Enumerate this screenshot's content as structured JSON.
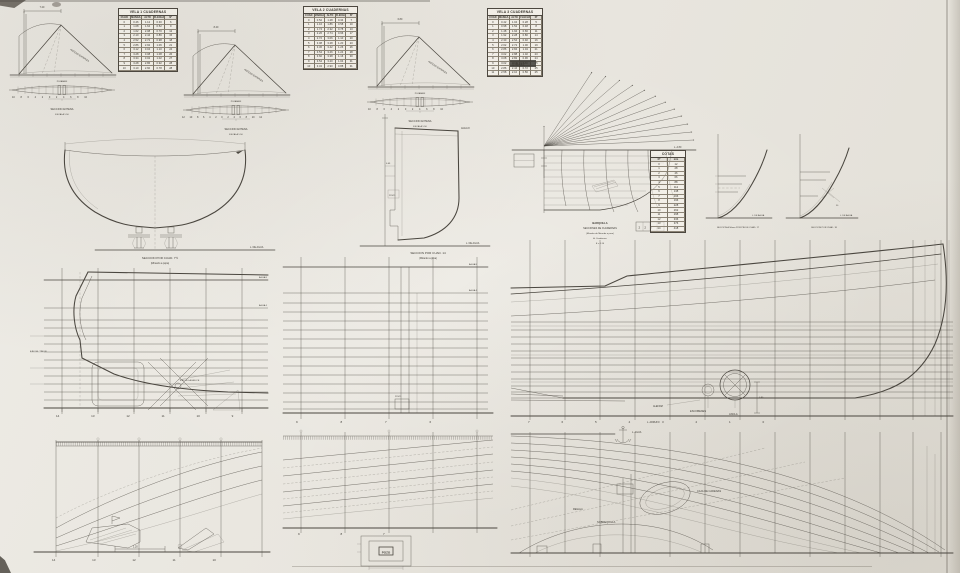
{
  "marks": {
    "corner_note": "2-8-32"
  },
  "sail_units": [
    {
      "leech_label": "ANTENA ENTERIZA",
      "mast_dim": "7.20",
      "base_label": "PUJAMEN",
      "plan_caption": "SECCION ANTENA",
      "sub_caption": "ESCALA 1:50"
    },
    {
      "leech_label": "ANTENA ENTERIZA",
      "mast_dim": "8.40",
      "base_label": "PUJAMEN",
      "plan_caption": "SECCION ANTENA",
      "sub_caption": "ESCALA 1:50"
    },
    {
      "leech_label": "ANTENA ENTERIZA",
      "mast_dim": "6.80",
      "base_label": "PUJAMEN",
      "plan_caption": "SECCION ANTENA",
      "sub_caption": "ESCALA 1:50"
    }
  ],
  "ticks": {
    "sail1": "10 8 6 4 2 0 2 4 6 8 10",
    "sail2": "12 10 8 6 4 2 0 2 4 6 8 10 12",
    "sail3": "10 8 6 4 2 0 2 4 6 8 10",
    "stern_profile": "14 13 12 11 10 9",
    "mid_profile": "9 8 7 6",
    "bow_profile": "7 6 5 4 3 2 1 0",
    "stern_plan": "14 13 12 11 10",
    "mid_plan": "9 8 7"
  },
  "sail_tables": [
    {
      "title": "VELA 1  CUADERNAS",
      "col_headers": [
        "CUAD",
        "MANGA",
        "ALTO",
        "FLECHA",
        "Nº"
      ],
      "rows": [
        [
          "0",
          "0.46",
          "1.12",
          "0.30",
          "6"
        ],
        [
          "1",
          "1.08",
          "1.64",
          "0.52",
          "9"
        ],
        [
          "2",
          "1.62",
          "2.08",
          "0.70",
          "12"
        ],
        [
          "3",
          "2.10",
          "2.44",
          "0.86",
          "15"
        ],
        [
          "4",
          "2.52",
          "2.72",
          "0.98",
          "18"
        ],
        [
          "5",
          "2.86",
          "2.92",
          "1.06",
          "21"
        ],
        [
          "6",
          "3.12",
          "3.04",
          "1.10",
          "24"
        ],
        [
          "7",
          "3.28",
          "3.08",
          "1.08",
          "26"
        ],
        [
          "8",
          "3.34",
          "3.02",
          "1.02",
          "27"
        ],
        [
          "9",
          "3.28",
          "2.86",
          "0.92",
          "28"
        ],
        [
          "10",
          "3.10",
          "2.60",
          "0.78",
          "28"
        ]
      ]
    },
    {
      "title": "VELA 2  CUADERNAS",
      "col_headers": [
        "CUAD",
        "MANGA",
        "ALTO",
        "FLECHA",
        "Nº"
      ],
      "rows": [
        [
          "0",
          "0.52",
          "1.28",
          "0.34",
          "7"
        ],
        [
          "1",
          "1.16",
          "1.86",
          "0.58",
          "10"
        ],
        [
          "2",
          "1.74",
          "2.32",
          "0.78",
          "13"
        ],
        [
          "3",
          "2.26",
          "2.74",
          "0.96",
          "17"
        ],
        [
          "4",
          "2.72",
          "3.06",
          "1.10",
          "20"
        ],
        [
          "5",
          "3.08",
          "3.28",
          "1.20",
          "23"
        ],
        [
          "6",
          "3.36",
          "3.42",
          "1.26",
          "26"
        ],
        [
          "7",
          "3.54",
          "3.46",
          "1.24",
          "28"
        ],
        [
          "8",
          "3.60",
          "3.38",
          "1.16",
          "30"
        ],
        [
          "9",
          "3.54",
          "3.20",
          "1.04",
          "31"
        ],
        [
          "10",
          "3.34",
          "2.90",
          "0.88",
          "31"
        ]
      ]
    },
    {
      "title": "VELA 3  CUADERNAS",
      "col_headers": [
        "CUAD",
        "MANGA",
        "ALTO",
        "FLECHA",
        "Nº"
      ],
      "rows": [
        [
          "0",
          "0.42",
          "1.04",
          "0.28",
          "5"
        ],
        [
          "1",
          "0.98",
          "1.52",
          "0.48",
          "8"
        ],
        [
          "2",
          "1.48",
          "1.94",
          "0.66",
          "11"
        ],
        [
          "3",
          "1.92",
          "2.28",
          "0.80",
          "14"
        ],
        [
          "4",
          "2.30",
          "2.54",
          "0.92",
          "16"
        ],
        [
          "5",
          "2.62",
          "2.72",
          "1.00",
          "19"
        ],
        [
          "6",
          "2.86",
          "2.84",
          "1.04",
          "21"
        ],
        [
          "7",
          "3.02",
          "2.88",
          "1.02",
          "23"
        ],
        [
          "8",
          "3.08",
          "2.82",
          "0.96",
          "24"
        ],
        [
          "9",
          "3.02",
          "2.68",
          "0.86",
          "25"
        ],
        [
          "10",
          "2.86",
          "2.44",
          "0.72",
          "25"
        ],
        [
          "11",
          "2.58",
          "2.10",
          "0.56",
          "25"
        ]
      ]
    }
  ],
  "stem_table": {
    "title": "COTAS",
    "col_headers": [
      "Nº",
      "mm"
    ],
    "rows": [
      [
        "0",
        "12"
      ],
      [
        "1",
        "28"
      ],
      [
        "2",
        "46"
      ],
      [
        "3",
        "66"
      ],
      [
        "4",
        "88"
      ],
      [
        "5",
        "112"
      ],
      [
        "6",
        "138"
      ],
      [
        "7",
        "166"
      ],
      [
        "8",
        "196"
      ],
      [
        "9",
        "228"
      ],
      [
        "10",
        "262"
      ],
      [
        "11",
        "298"
      ],
      [
        "12",
        "336"
      ],
      [
        "13",
        "376"
      ],
      [
        "14",
        "418"
      ]
    ]
  },
  "sections": {
    "midship": {
      "caption1": "SECCION POR CUAD. 7½",
      "caption2": "(Mirando a popa)",
      "baseline_label": "L. DE AGUA"
    },
    "transom": {
      "caption1": "SECCION POR CUAD. 14",
      "caption2": "(Mirando a proa)",
      "baseline_label": "L. DE AGUA",
      "top_label": "AGUA 8",
      "dim_label": "0.45",
      "box_label": "POZO"
    },
    "stem": {
      "caption_lines": [
        "BARQUILLA",
        "SECCIONES DE CUADERNAS",
        "(Miradas de Mirando a proa)",
        "A. Cuadernas",
        "E = 1:10"
      ],
      "baseline_label": "L. A 80",
      "scale_text": "2 2 3 1"
    },
    "small1": {
      "caption": "SECCION A 50mm POR PIE DE CUAD. 17",
      "baseline_label": "L. DE AGUA",
      "note": "50"
    },
    "small2": {
      "caption": "SECCION POR CUAD. 18",
      "baseline_label": "L. DE AGUA"
    }
  },
  "profiles": {
    "stern": {
      "top_water_label": "AGUA 8",
      "mid_water_label": "AGUA 4",
      "rudder_axis_label": "EJE DEL TIMON",
      "prop_axis_label": "EJE DE LA HELICE"
    },
    "mid": {
      "top_water_label": "AGUA 8",
      "mid_water_label": "AGUA 4",
      "well_label": "POZO"
    },
    "bow": {
      "hawse_label": "ESCOBENES",
      "anchor_label": "ANCLA",
      "rabbet_label": "ALEFRIZ",
      "sheer_label": "L. ARRUFO",
      "dim_label": "0.90"
    }
  },
  "halfbreadths": {
    "stern": {
      "dim_label": "1.20"
    },
    "mid": {
      "well_label": "POZO"
    },
    "bow": {
      "top_label": "L. AGUA",
      "chain_label": "CAJA DE CADENAS",
      "keelson_label": "SOBREQUILLA",
      "rail_label": "REGALA"
    }
  }
}
